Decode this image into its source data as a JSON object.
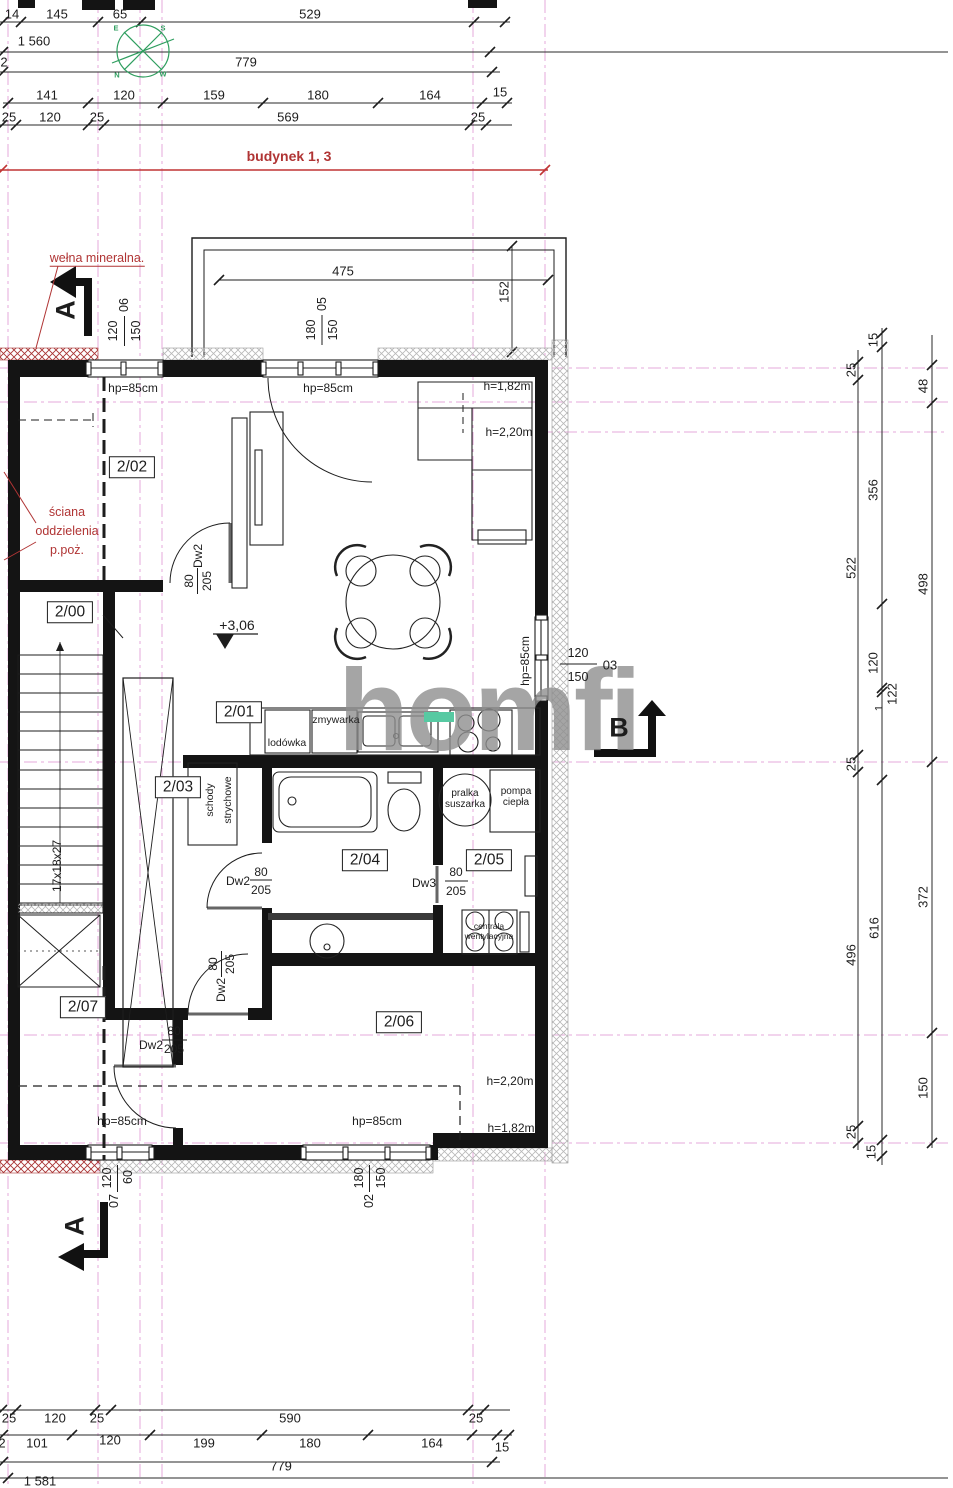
{
  "watermark": {
    "text": "homfi",
    "accent_color": "#57c9a2",
    "text_color": "#8f8f8f"
  },
  "colors": {
    "line": "#1d1d1d",
    "axis_pink": "#e6a8db",
    "note_red": "#b03434",
    "compass_green": "#2f9e5f"
  },
  "labels": [
    {
      "n": "dim-label",
      "t": "14",
      "x": 12,
      "y": 14
    },
    {
      "n": "dim-label",
      "t": "145",
      "x": 57,
      "y": 14
    },
    {
      "n": "dim-label",
      "t": "65",
      "x": 120,
      "y": 14
    },
    {
      "n": "dim-label",
      "t": "529",
      "x": 310,
      "y": 14
    },
    {
      "n": "dim-label",
      "t": "1 560",
      "x": 34,
      "y": 41
    },
    {
      "n": "axis-number",
      "t": "2",
      "x": 4,
      "y": 62
    },
    {
      "n": "dim-label",
      "t": "779",
      "x": 246,
      "y": 62
    },
    {
      "n": "dim-label",
      "t": "141",
      "x": 47,
      "y": 95
    },
    {
      "n": "dim-label",
      "t": "120",
      "x": 124,
      "y": 95
    },
    {
      "n": "dim-label",
      "t": "159",
      "x": 214,
      "y": 95
    },
    {
      "n": "dim-label",
      "t": "180",
      "x": 318,
      "y": 95
    },
    {
      "n": "dim-label",
      "t": "164",
      "x": 430,
      "y": 95
    },
    {
      "n": "dim-label",
      "t": "15",
      "x": 500,
      "y": 92
    },
    {
      "n": "dim-label",
      "t": "25",
      "x": 9,
      "y": 117
    },
    {
      "n": "dim-label",
      "t": "120",
      "x": 50,
      "y": 117
    },
    {
      "n": "dim-label",
      "t": "25",
      "x": 97,
      "y": 117
    },
    {
      "n": "dim-label",
      "t": "569",
      "x": 288,
      "y": 117
    },
    {
      "n": "dim-label",
      "t": "25",
      "x": 478,
      "y": 117
    },
    {
      "n": "building-extent-label",
      "t": "budynek 1, 3",
      "x": 289,
      "y": 156,
      "c": "red bold",
      "s": 14
    },
    {
      "n": "compass-letter",
      "t": "E",
      "x": 116,
      "y": 28,
      "c": "green"
    },
    {
      "n": "compass-letter",
      "t": "S",
      "x": 163,
      "y": 28,
      "c": "green"
    },
    {
      "n": "compass-letter",
      "t": "N",
      "x": 117,
      "y": 75,
      "c": "green"
    },
    {
      "n": "compass-letter",
      "t": "W",
      "x": 163,
      "y": 74,
      "c": "green"
    },
    {
      "n": "note-welna-mineralna",
      "t": "wełna mineralna.",
      "x": 97,
      "y": 259,
      "c": "red u",
      "s": 12.5
    },
    {
      "n": "dim-label",
      "t": "475",
      "x": 343,
      "y": 271
    },
    {
      "n": "dim-label",
      "t": "152",
      "x": 504,
      "y": 292,
      "r": -90
    },
    {
      "n": "window-dim",
      "t": "120",
      "x": 113,
      "y": 331,
      "r": -90,
      "s": 12.5
    },
    {
      "n": "window-dim",
      "t": "150",
      "x": 136,
      "y": 331,
      "r": -90,
      "s": 12.5
    },
    {
      "n": "window-number",
      "t": "06",
      "x": 124,
      "y": 305,
      "r": -90,
      "s": 12.5
    },
    {
      "n": "window-dim",
      "t": "180",
      "x": 311,
      "y": 330,
      "r": -90,
      "s": 12.5
    },
    {
      "n": "window-dim",
      "t": "150",
      "x": 333,
      "y": 330,
      "r": -90,
      "s": 12.5
    },
    {
      "n": "window-number",
      "t": "05",
      "x": 322,
      "y": 304,
      "r": -90,
      "s": 12.5
    },
    {
      "n": "window-sill-height-label",
      "t": "hp=85cm",
      "x": 133,
      "y": 388,
      "s": 12
    },
    {
      "n": "window-sill-height-label",
      "t": "hp=85cm",
      "x": 328,
      "y": 388,
      "s": 12
    },
    {
      "n": "section-marker-letter",
      "t": "A",
      "x": 66,
      "y": 310,
      "c": "sec",
      "r": -90
    },
    {
      "n": "room-label-2-02",
      "t": "2/02",
      "x": 132,
      "y": 467,
      "c": "room"
    },
    {
      "n": "note-sciana",
      "t": "ściana",
      "x": 67,
      "y": 512,
      "c": "red",
      "s": 12.5
    },
    {
      "n": "note-sciana",
      "t": "oddzielenia",
      "x": 67,
      "y": 531,
      "c": "red",
      "s": 12.5
    },
    {
      "n": "note-sciana",
      "t": "p.poż.",
      "x": 67,
      "y": 550,
      "c": "red",
      "s": 12.5
    },
    {
      "n": "ceiling-height-label",
      "t": "h=1,82m",
      "x": 507,
      "y": 386,
      "s": 12
    },
    {
      "n": "ceiling-height-label",
      "t": "h=2,20m",
      "x": 509,
      "y": 432,
      "s": 12
    },
    {
      "n": "door-tag",
      "t": "Dw2",
      "x": 198,
      "y": 556,
      "r": -90,
      "s": 12
    },
    {
      "n": "door-tag",
      "t": "80",
      "x": 189,
      "y": 581,
      "r": -90,
      "s": 12
    },
    {
      "n": "door-tag",
      "t": "205",
      "x": 207,
      "y": 581,
      "r": -90,
      "s": 12
    },
    {
      "n": "room-label-2-00",
      "t": "2/00",
      "x": 70,
      "y": 612,
      "c": "room"
    },
    {
      "n": "level-marker-label",
      "t": "+3,06",
      "x": 237,
      "y": 625,
      "s": 14
    },
    {
      "n": "window-sill-height-label",
      "t": "hp=85cm",
      "x": 525,
      "y": 661,
      "r": -90,
      "s": 12
    },
    {
      "n": "window-dim",
      "t": "120",
      "x": 578,
      "y": 653,
      "s": 12.5
    },
    {
      "n": "window-dim",
      "t": "150",
      "x": 578,
      "y": 677,
      "s": 12.5
    },
    {
      "n": "window-number",
      "t": "03",
      "x": 610,
      "y": 665
    },
    {
      "n": "room-label-2-01",
      "t": "2/01",
      "x": 239,
      "y": 712,
      "c": "room"
    },
    {
      "n": "section-marker-letter",
      "t": "B",
      "x": 619,
      "y": 728,
      "c": "sec"
    },
    {
      "n": "fridge-label",
      "t": "lodówka",
      "x": 287,
      "y": 743,
      "s": 10.5
    },
    {
      "n": "dishwasher-label",
      "t": "zmywarka",
      "x": 336,
      "y": 720,
      "s": 10.5
    },
    {
      "n": "room-label-2-03",
      "t": "2/03",
      "x": 178,
      "y": 787,
      "c": "room"
    },
    {
      "n": "attic-stairs-label",
      "t": "schody",
      "x": 210,
      "y": 800,
      "r": -90,
      "s": 10.5
    },
    {
      "n": "attic-stairs-label",
      "t": "strychowe",
      "x": 228,
      "y": 800,
      "r": -90,
      "s": 10.5
    },
    {
      "n": "washer-dryer-label",
      "t": "pralka",
      "x": 465,
      "y": 794,
      "s": 10
    },
    {
      "n": "washer-dryer-label",
      "t": "suszarka",
      "x": 465,
      "y": 805,
      "s": 10
    },
    {
      "n": "heat-pump-label",
      "t": "pompa",
      "x": 516,
      "y": 792,
      "s": 10
    },
    {
      "n": "heat-pump-label",
      "t": "ciepła",
      "x": 516,
      "y": 803,
      "s": 10
    },
    {
      "n": "room-label-2-04",
      "t": "2/04",
      "x": 365,
      "y": 860,
      "c": "room"
    },
    {
      "n": "room-label-2-05",
      "t": "2/05",
      "x": 489,
      "y": 860,
      "c": "room"
    },
    {
      "n": "stairs-dim-label",
      "t": "17x18x27",
      "x": 57,
      "y": 866,
      "r": -90,
      "s": 12
    },
    {
      "n": "door-tag",
      "t": "Dw2",
      "x": 238,
      "y": 881,
      "s": 12
    },
    {
      "n": "door-tag",
      "t": "80",
      "x": 261,
      "y": 872,
      "s": 12
    },
    {
      "n": "door-tag",
      "t": "205",
      "x": 261,
      "y": 890,
      "s": 12
    },
    {
      "n": "door-tag",
      "t": "Dw3",
      "x": 424,
      "y": 883,
      "s": 12
    },
    {
      "n": "door-tag",
      "t": "80",
      "x": 456,
      "y": 872,
      "s": 12
    },
    {
      "n": "door-tag",
      "t": "205",
      "x": 456,
      "y": 891,
      "s": 12
    },
    {
      "n": "ventilation-unit-label",
      "t": "centrala",
      "x": 489,
      "y": 926,
      "s": 8.5
    },
    {
      "n": "ventilation-unit-label",
      "t": "wentylacyjna",
      "x": 489,
      "y": 936,
      "s": 8.5
    },
    {
      "n": "door-tag",
      "t": "Dw2",
      "x": 221,
      "y": 990,
      "r": -90,
      "s": 12
    },
    {
      "n": "door-tag",
      "t": "80",
      "x": 213,
      "y": 964,
      "r": -90,
      "s": 12
    },
    {
      "n": "door-tag",
      "t": "205",
      "x": 230,
      "y": 964,
      "r": -90,
      "s": 12
    },
    {
      "n": "room-label-2-07",
      "t": "2/07",
      "x": 83,
      "y": 1007,
      "c": "room"
    },
    {
      "n": "room-label-2-06",
      "t": "2/06",
      "x": 399,
      "y": 1022,
      "c": "room"
    },
    {
      "n": "door-tag",
      "t": "Dw2",
      "x": 151,
      "y": 1045,
      "s": 12
    },
    {
      "n": "door-tag",
      "t": "80",
      "x": 174,
      "y": 1031,
      "s": 12
    },
    {
      "n": "door-tag",
      "t": "205",
      "x": 174,
      "y": 1049,
      "s": 12
    },
    {
      "n": "ceiling-height-label",
      "t": "h=2,20m",
      "x": 510,
      "y": 1081,
      "s": 12
    },
    {
      "n": "window-sill-height-label",
      "t": "hp=85cm",
      "x": 122,
      "y": 1121,
      "s": 12
    },
    {
      "n": "window-sill-height-label",
      "t": "hp=85cm",
      "x": 377,
      "y": 1121,
      "s": 12
    },
    {
      "n": "ceiling-height-label",
      "t": "h=1,82m",
      "x": 511,
      "y": 1128,
      "s": 12
    },
    {
      "n": "window-dim",
      "t": "120",
      "x": 107,
      "y": 1178,
      "r": -90,
      "s": 12.5
    },
    {
      "n": "window-dim",
      "t": "60",
      "x": 128,
      "y": 1177,
      "r": -90,
      "s": 12.5
    },
    {
      "n": "window-number",
      "t": "07",
      "x": 114,
      "y": 1201,
      "r": -90,
      "s": 12.5
    },
    {
      "n": "window-dim",
      "t": "180",
      "x": 359,
      "y": 1178,
      "r": -90,
      "s": 12.5
    },
    {
      "n": "window-dim",
      "t": "150",
      "x": 381,
      "y": 1178,
      "r": -90,
      "s": 12.5
    },
    {
      "n": "window-number",
      "t": "02",
      "x": 369,
      "y": 1201,
      "r": -90,
      "s": 12.5
    },
    {
      "n": "section-marker-letter",
      "t": "A",
      "x": 75,
      "y": 1226,
      "c": "sec",
      "r": -90
    },
    {
      "n": "dim-label",
      "t": "25",
      "x": 851,
      "y": 370,
      "r": -90
    },
    {
      "n": "dim-label",
      "t": "522",
      "x": 851,
      "y": 568,
      "r": -90
    },
    {
      "n": "dim-label",
      "t": "25",
      "x": 851,
      "y": 764,
      "r": -90
    },
    {
      "n": "dim-label",
      "t": "496",
      "x": 851,
      "y": 955,
      "r": -90
    },
    {
      "n": "dim-label",
      "t": "25",
      "x": 851,
      "y": 1132,
      "r": -90
    },
    {
      "n": "dim-label",
      "t": "15",
      "x": 873,
      "y": 340,
      "r": -90
    },
    {
      "n": "dim-label",
      "t": "356",
      "x": 873,
      "y": 490,
      "r": -90
    },
    {
      "n": "dim-label",
      "t": "120",
      "x": 873,
      "y": 663,
      "r": -90
    },
    {
      "n": "dim-label",
      "t": "122",
      "x": 892,
      "y": 694,
      "r": -90
    },
    {
      "n": "dim-label",
      "t": "1",
      "x": 880,
      "y": 708,
      "r": -90,
      "s": 11
    },
    {
      "n": "dim-label",
      "t": "616",
      "x": 874,
      "y": 928,
      "r": -90
    },
    {
      "n": "dim-label",
      "t": "15",
      "x": 871,
      "y": 1152,
      "r": -90
    },
    {
      "n": "dim-label",
      "t": "48",
      "x": 923,
      "y": 386,
      "r": -90
    },
    {
      "n": "dim-label",
      "t": "498",
      "x": 923,
      "y": 584,
      "r": -90
    },
    {
      "n": "dim-label",
      "t": "372",
      "x": 923,
      "y": 897,
      "r": -90
    },
    {
      "n": "dim-label",
      "t": "150",
      "x": 923,
      "y": 1088,
      "r": -90
    },
    {
      "n": "dim-label",
      "t": "25",
      "x": 9,
      "y": 1418
    },
    {
      "n": "dim-label",
      "t": "120",
      "x": 55,
      "y": 1418
    },
    {
      "n": "dim-label",
      "t": "25",
      "x": 97,
      "y": 1418
    },
    {
      "n": "dim-label",
      "t": "590",
      "x": 290,
      "y": 1418
    },
    {
      "n": "dim-label",
      "t": "25",
      "x": 476,
      "y": 1418
    },
    {
      "n": "axis-number",
      "t": "2",
      "x": 2,
      "y": 1443
    },
    {
      "n": "dim-label",
      "t": "101",
      "x": 37,
      "y": 1443
    },
    {
      "n": "dim-label",
      "t": "120",
      "x": 110,
      "y": 1440
    },
    {
      "n": "dim-label",
      "t": "199",
      "x": 204,
      "y": 1443
    },
    {
      "n": "dim-label",
      "t": "180",
      "x": 310,
      "y": 1443
    },
    {
      "n": "dim-label",
      "t": "164",
      "x": 432,
      "y": 1443
    },
    {
      "n": "dim-label",
      "t": "15",
      "x": 502,
      "y": 1447
    },
    {
      "n": "dim-label",
      "t": "779",
      "x": 281,
      "y": 1466
    },
    {
      "n": "dim-label",
      "t": "1 581",
      "x": 40,
      "y": 1481
    }
  ]
}
